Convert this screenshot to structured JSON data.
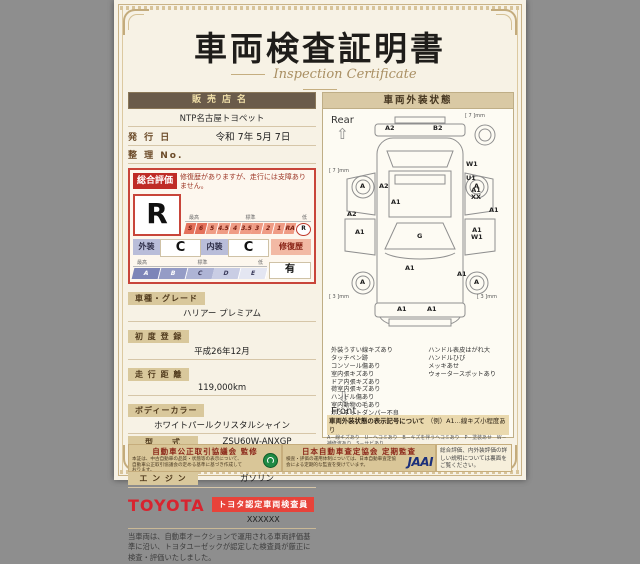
{
  "title": "車両検査証明書",
  "subtitle": "Inspection Certificate",
  "left": {
    "dealer_header": "販売店名",
    "dealer_name": "NTP名古屋トヨペット",
    "issue_label": "発 行 日",
    "issue_value": "令和 7年 5月 7日",
    "ref_label": "整 理 No.",
    "eval": {
      "label": "総合評価",
      "grade": "R",
      "comment": "修復歴がありますが、走行には支障ありません。",
      "scale_max": "最高",
      "scale_std": "標準",
      "scale_low": "低",
      "cells": [
        "S",
        "6",
        "5",
        "4.5",
        "4",
        "3.5",
        "3",
        "2",
        "1",
        "RA",
        "R"
      ],
      "ext_label": "外装",
      "ext_grade": "C",
      "int_label": "内装",
      "int_grade": "C",
      "repair_label": "修復歴",
      "repair_value": "有",
      "letters": [
        "A",
        "B",
        "C",
        "D",
        "E"
      ]
    },
    "specs": [
      {
        "label": "車種・グレード",
        "value": "ハリアー プレミアム"
      },
      {
        "label": "初 度 登 録",
        "value": "平成26年12月"
      },
      {
        "label": "走 行 距 離",
        "value": "119,000km"
      },
      {
        "label": "ボディーカラー",
        "value": "ホワイトパールクリスタルシャイン"
      },
      {
        "label": "型　　式",
        "value": "ZSU60W-ANXGP"
      },
      {
        "label": "車 台 番 号",
        "value": "XXXXXXX890"
      },
      {
        "label": "エ ン ジ ン",
        "value": "ガソリン"
      }
    ],
    "brand": "TOYOTA",
    "badge": "トヨタ認定車両検査員",
    "inspector": "XXXXXX",
    "disclaimer": "当車両は、自動車オークションで運用される車両評価基準に沿い、トヨタユーゼックが認定した検査員が厳正に検査・評価いたしました。"
  },
  "right": {
    "header": "車両外装状態",
    "rear": "Rear",
    "front": "Front",
    "wheel_mark": "A",
    "tread_rear": "[ 7 ]mm",
    "tread_front": "[ 3 ]mm",
    "codes": {
      "rb_l": "A2",
      "rb_r": "B2",
      "r_w1": "W1",
      "r_u1": "U1",
      "r_a1xx": "A1\nXX",
      "r_a1": "A1",
      "r_a1w1": "A1\nW1",
      "r_front": "A1",
      "l_a2_in": "A2",
      "l_a1_top": "A1",
      "l_a2_out": "A2",
      "l_a1": "A1",
      "glass": "G",
      "hood": "A1",
      "fb_l": "A1",
      "fb_r": "A1"
    },
    "notes_col1": [
      "外装うすい線キズあり",
      "タッチペン跡",
      "コンソール傷あり",
      "室内張キズあり",
      "ドア内張キズあり",
      "荷室内張キズあり",
      "ハンドル傷あり",
      "室内動物の毛あり",
      "ボンネットダンパー不良",
      "▼センターピラーW"
    ],
    "notes_col2": [
      "ハンドル表皮はがれ大",
      "ハンドルひび",
      "メッキあせ",
      "ウォータースポットあり"
    ],
    "legend_title": "車両外装状態の表示記号について",
    "legend_example": "（例）A1…線キズ小程度あり",
    "legend_lines": [
      "A－線キズあり　U－ヘコミあり　B－キズを伴うヘコミあり　P－塗装あせ　W－補修波あり　S－サビあり",
      "C－腐食あり　G－フロントガラスにキズあり　X－要交換（裏面に記載あり）　XX－交換済あり",
      "1－小程度　2－中程度　3－大程度　・ドアミラー等の表示は省略しています。"
    ]
  },
  "footer": {
    "left_title": "自動車公正取引協議会 監修",
    "left_text": "本証は、中古自動車の品質・状態等の表示について、自動車公正取引協議会の定める基準に基づき作成しております。",
    "right_title": "日本自動車査定協会 定期監査",
    "right_text": "検査・評価の運用体制については、日本自動車査定協会による定期的な監査を受けています。",
    "jaai": "JAAI",
    "note": "総合評価、内外装評価の詳しい説明については裏面をご覧ください。"
  }
}
